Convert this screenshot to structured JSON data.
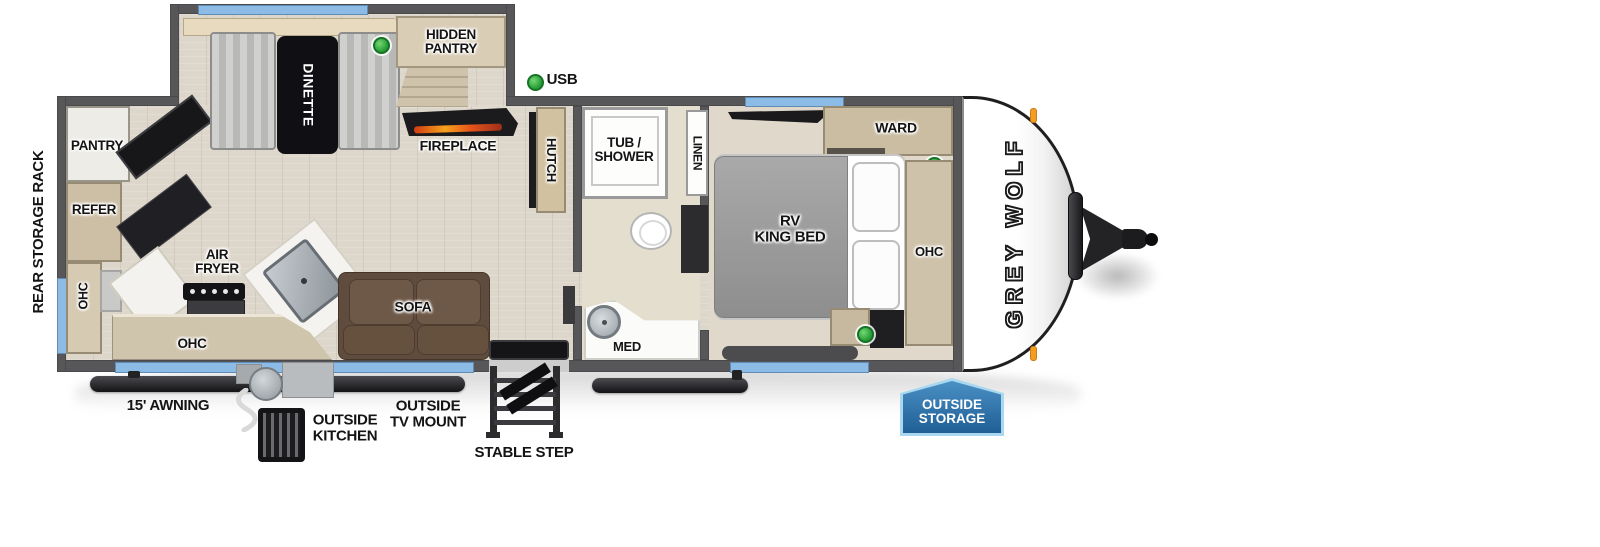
{
  "title": "Grey Wolf travel trailer floor plan",
  "brand": "GREY WOLF",
  "colors": {
    "wall": "#57575a",
    "window_blue": "#8cbce6",
    "floor_wood": "#ddd6ca",
    "cabinet_wood": "#cdc0a8",
    "sofa_brown": "#6e5847",
    "badge_blue": "#2a6fad",
    "badge_border": "#a8d8ef",
    "indicator_green": "#2da13b",
    "marker_orange": "#f59c23"
  },
  "exterior": {
    "rear_storage_rack": "REAR STORAGE RACK",
    "awning": "15' AWNING",
    "outside_kitchen": [
      "OUTSIDE",
      "KITCHEN"
    ],
    "outside_tv_mount": [
      "OUTSIDE",
      "TV MOUNT"
    ],
    "stable_step": "STABLE STEP",
    "outside_storage": [
      "OUTSIDE",
      "STORAGE"
    ]
  },
  "legend": {
    "usb": "USB"
  },
  "kitchen": {
    "pantry": "PANTRY",
    "refer": "REFER",
    "ohc_left": "OHC",
    "air_fryer": [
      "AIR",
      "FRYER"
    ],
    "ohc_lower": "OHC"
  },
  "dinette": {
    "label": "DINETTE",
    "hidden_pantry": [
      "HIDDEN",
      "PANTRY"
    ]
  },
  "living": {
    "fireplace": "FIREPLACE",
    "hutch": "HUTCH",
    "sofa": "SOFA"
  },
  "bath": {
    "tub_shower": [
      "TUB /",
      "SHOWER"
    ],
    "linen": "LINEN",
    "med": "MED"
  },
  "bedroom": {
    "bed": [
      "RV",
      "KING BED"
    ],
    "ward": "WARD",
    "ohc_front": "OHC"
  }
}
